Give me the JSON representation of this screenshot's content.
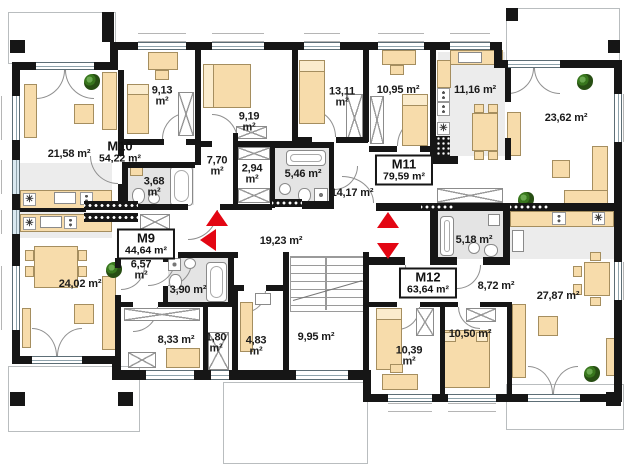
{
  "plan": {
    "type": "residential-floor-plan",
    "unit": "m²",
    "apartments": [
      {
        "id": "M9",
        "area": "44,64 m²"
      },
      {
        "id": "M10",
        "area": "54,22 m²"
      },
      {
        "id": "M11",
        "area": "79,59 m²"
      },
      {
        "id": "M12",
        "area": "63,64 m²"
      }
    ],
    "rooms": [
      {
        "name": "living-room-m10",
        "value": "21,58",
        "unit": "m²"
      },
      {
        "name": "bedroom-1-m10",
        "value": "9,13",
        "unit": "m²"
      },
      {
        "name": "bedroom-2-m10",
        "value": "9,19",
        "unit": "m²"
      },
      {
        "name": "bedroom-1-m11",
        "value": "13,11",
        "unit": "m²"
      },
      {
        "name": "bedroom-2-m11",
        "value": "10,95",
        "unit": "m²"
      },
      {
        "name": "kitchen-m11",
        "value": "11,16",
        "unit": "m²"
      },
      {
        "name": "living-room-m11",
        "value": "23,62",
        "unit": "m²"
      },
      {
        "name": "hall-m10",
        "value": "7,70",
        "unit": "m²"
      },
      {
        "name": "wardrobe-m10",
        "value": "2,94",
        "unit": "m²"
      },
      {
        "name": "bathroom-m10",
        "value": "3,68",
        "unit": "m²"
      },
      {
        "name": "bathroom-m11",
        "value": "5,46",
        "unit": "m²"
      },
      {
        "name": "hall-m11",
        "value": "14,17",
        "unit": "m²"
      },
      {
        "name": "corridor-common",
        "value": "19,23",
        "unit": "m²"
      },
      {
        "name": "hall-m9",
        "value": "6,57",
        "unit": "m²"
      },
      {
        "name": "bathroom-m9",
        "value": "3,90",
        "unit": "m²"
      },
      {
        "name": "living-room-m9",
        "value": "24,02",
        "unit": "m²"
      },
      {
        "name": "bedroom-m9",
        "value": "8,33",
        "unit": "m²"
      },
      {
        "name": "wardrobe-m9",
        "value": "1,80",
        "unit": "m²"
      },
      {
        "name": "storage-common",
        "value": "4,83",
        "unit": "m²"
      },
      {
        "name": "staircase-common",
        "value": "9,95",
        "unit": "m²"
      },
      {
        "name": "bathroom-m12",
        "value": "5,18",
        "unit": "m²"
      },
      {
        "name": "hall-m12",
        "value": "8,72",
        "unit": "m²"
      },
      {
        "name": "living-room-m12",
        "value": "27,87",
        "unit": "m²"
      },
      {
        "name": "bedroom-1-m12",
        "value": "10,50",
        "unit": "m²"
      },
      {
        "name": "bedroom-2-m12",
        "value": "10,39",
        "unit": "m²"
      }
    ],
    "symbols": {
      "stove": "✳"
    },
    "colors": {
      "wall": "#161616",
      "furniture": "#f7dcab",
      "furniture_border": "#a58e5f",
      "bath_floor": "#e4e4e4",
      "arrow_red": "#e30613",
      "plant_green": "#38761d",
      "window_tint": "#d9e8f0"
    }
  }
}
